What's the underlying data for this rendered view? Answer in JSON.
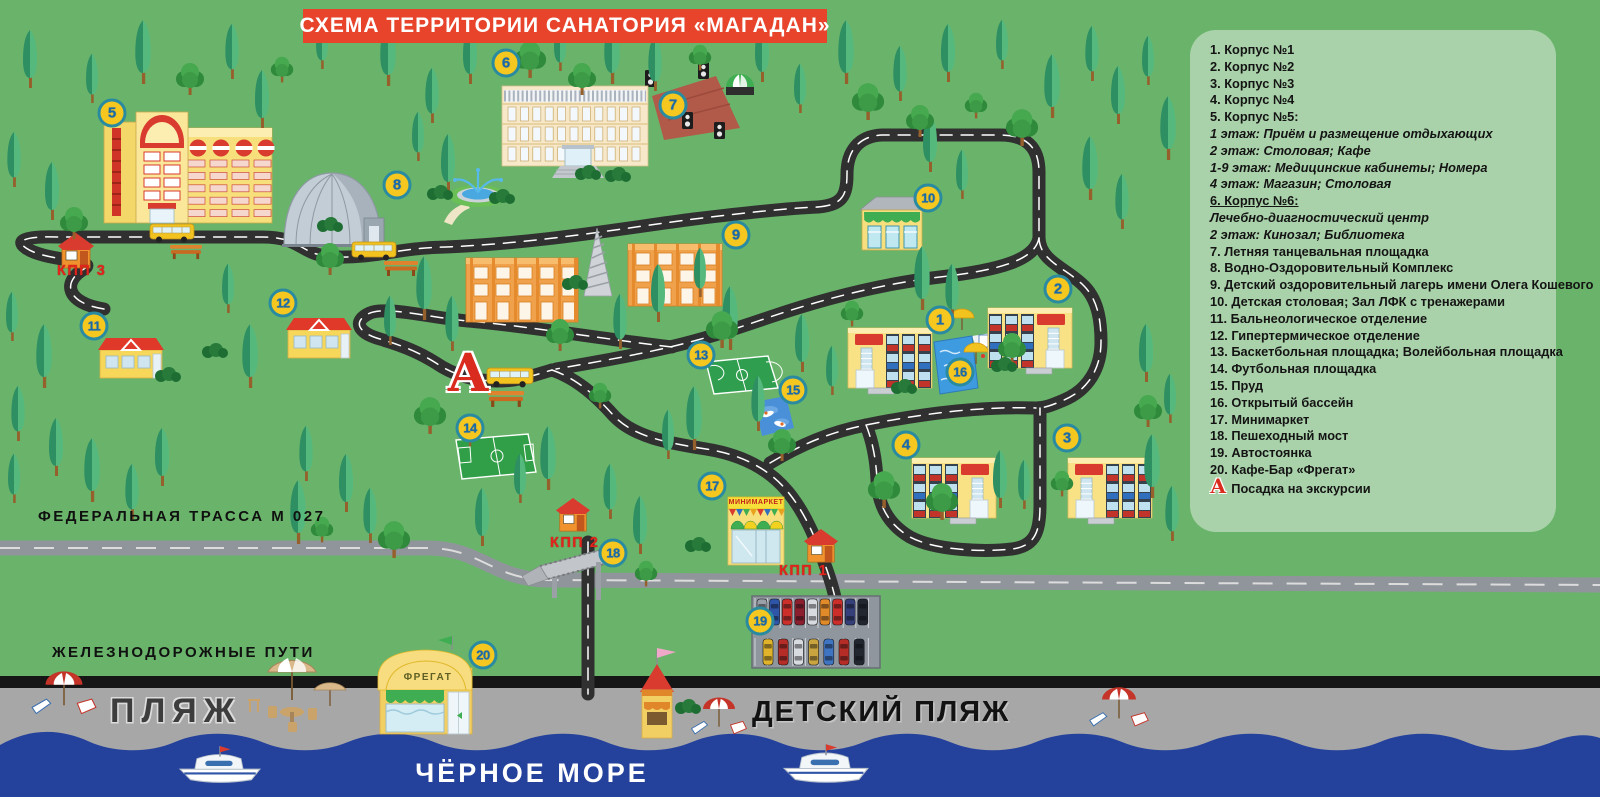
{
  "title": "СХЕМА ТЕРРИТОРИИ САНАТОРИЯ «МАГАДАН»",
  "legend": {
    "items": [
      {
        "text": "1. Корпус №1",
        "style": "b"
      },
      {
        "text": "2. Корпус №2",
        "style": "b"
      },
      {
        "text": "3. Корпус №3",
        "style": "b"
      },
      {
        "text": "4. Корпус №4",
        "style": "b"
      },
      {
        "text": "5. Корпус №5:",
        "style": "b"
      },
      {
        "text": "1 этаж: Приём и размещение отдыхающих",
        "style": "i"
      },
      {
        "text": "2 этаж: Столовая; Кафе",
        "style": "i"
      },
      {
        "text": "1-9 этаж: Медицинские кабинеты; Номера",
        "style": "i"
      },
      {
        "text": "4 этаж: Магазин; Столовая",
        "style": "i"
      },
      {
        "text": "6. Корпус №6:",
        "style": "bu"
      },
      {
        "text": "Лечебно-диагностический центр",
        "style": "i"
      },
      {
        "text": "2 этаж: Кинозал; Библиотека",
        "style": "i"
      },
      {
        "text": "7. Летняя танцевальная площадка",
        "style": "b"
      },
      {
        "text": "8. Водно-Оздоровительный Комплекс",
        "style": "b"
      },
      {
        "text": "9. Детский оздоровительный лагерь имени Олега Кошевого",
        "style": "b"
      },
      {
        "text": "10. Детская столовая; Зал ЛФК с тренажерами",
        "style": "b"
      },
      {
        "text": "11. Бальнеологическое отделение",
        "style": "b"
      },
      {
        "text": "12. Гипертермическое отделение",
        "style": "b"
      },
      {
        "text": "13. Баскетбольная площадка; Волейбольная площадка",
        "style": "b"
      },
      {
        "text": "14. Футбольная площадка",
        "style": "b"
      },
      {
        "text": "15. Пруд",
        "style": "b"
      },
      {
        "text": "16. Открытый бассейн",
        "style": "b"
      },
      {
        "text": "17. Минимаркет",
        "style": "b"
      },
      {
        "text": "18. Пешеходный мост",
        "style": "b"
      },
      {
        "text": "19. Автостоянка",
        "style": "b"
      },
      {
        "text": "20. Кафе-Бар «Фрегат»",
        "style": "b"
      },
      {
        "text": "Посадка на экскурсии",
        "style": "b",
        "icon": "А"
      }
    ]
  },
  "map": {
    "labels": {
      "kpp1": "КПП 1",
      "kpp2": "КПП 2",
      "kpp3": "КПП 3",
      "highway": "ФЕДЕРАЛЬНАЯ ТРАССА М 027",
      "railway": "ЖЕЛЕЗНОДОРОЖНЫЕ ПУТИ",
      "beach": "ПЛЯЖ",
      "kids_beach": "ДЕТСКИЙ ПЛЯЖ",
      "sea": "ЧЁРНОЕ МОРЕ",
      "minimarket_sign": "МИНИМАРКЕТ",
      "fregat_sign": "ФРЕГАТ",
      "excursion_marker": "А"
    },
    "markers": [
      {
        "label": "1",
        "x": 940,
        "y": 320
      },
      {
        "label": "2",
        "x": 1058,
        "y": 289
      },
      {
        "label": "3",
        "x": 1067,
        "y": 438
      },
      {
        "label": "4",
        "x": 906,
        "y": 445
      },
      {
        "label": "5",
        "x": 112,
        "y": 113
      },
      {
        "label": "6",
        "x": 506,
        "y": 63
      },
      {
        "label": "7",
        "x": 673,
        "y": 105
      },
      {
        "label": "8",
        "x": 397,
        "y": 185
      },
      {
        "label": "9",
        "x": 736,
        "y": 235
      },
      {
        "label": "10",
        "x": 928,
        "y": 198
      },
      {
        "label": "11",
        "x": 94,
        "y": 326
      },
      {
        "label": "12",
        "x": 283,
        "y": 303
      },
      {
        "label": "13",
        "x": 701,
        "y": 355
      },
      {
        "label": "14",
        "x": 470,
        "y": 428
      },
      {
        "label": "15",
        "x": 793,
        "y": 390
      },
      {
        "label": "16",
        "x": 960,
        "y": 372
      },
      {
        "label": "17",
        "x": 712,
        "y": 486
      },
      {
        "label": "18",
        "x": 613,
        "y": 553
      },
      {
        "label": "19",
        "x": 760,
        "y": 621
      },
      {
        "label": "20",
        "x": 483,
        "y": 655
      }
    ]
  },
  "colors": {
    "grass": "#69b46a",
    "legend_panel": "#aad2aa",
    "banner_red": "#e8432b",
    "road_black": "#303030",
    "highway_gray": "#90959b",
    "railway_black": "#161616",
    "beach_sand": "#a7a7a7",
    "sea_blue": "#24419b",
    "badge_fill": "#f6c71f",
    "badge_ring": "#2a8ba0",
    "badge_text": "#1b6aa8",
    "kpp_red": "#e2251c",
    "marker_a_red": "#d92b1e"
  }
}
